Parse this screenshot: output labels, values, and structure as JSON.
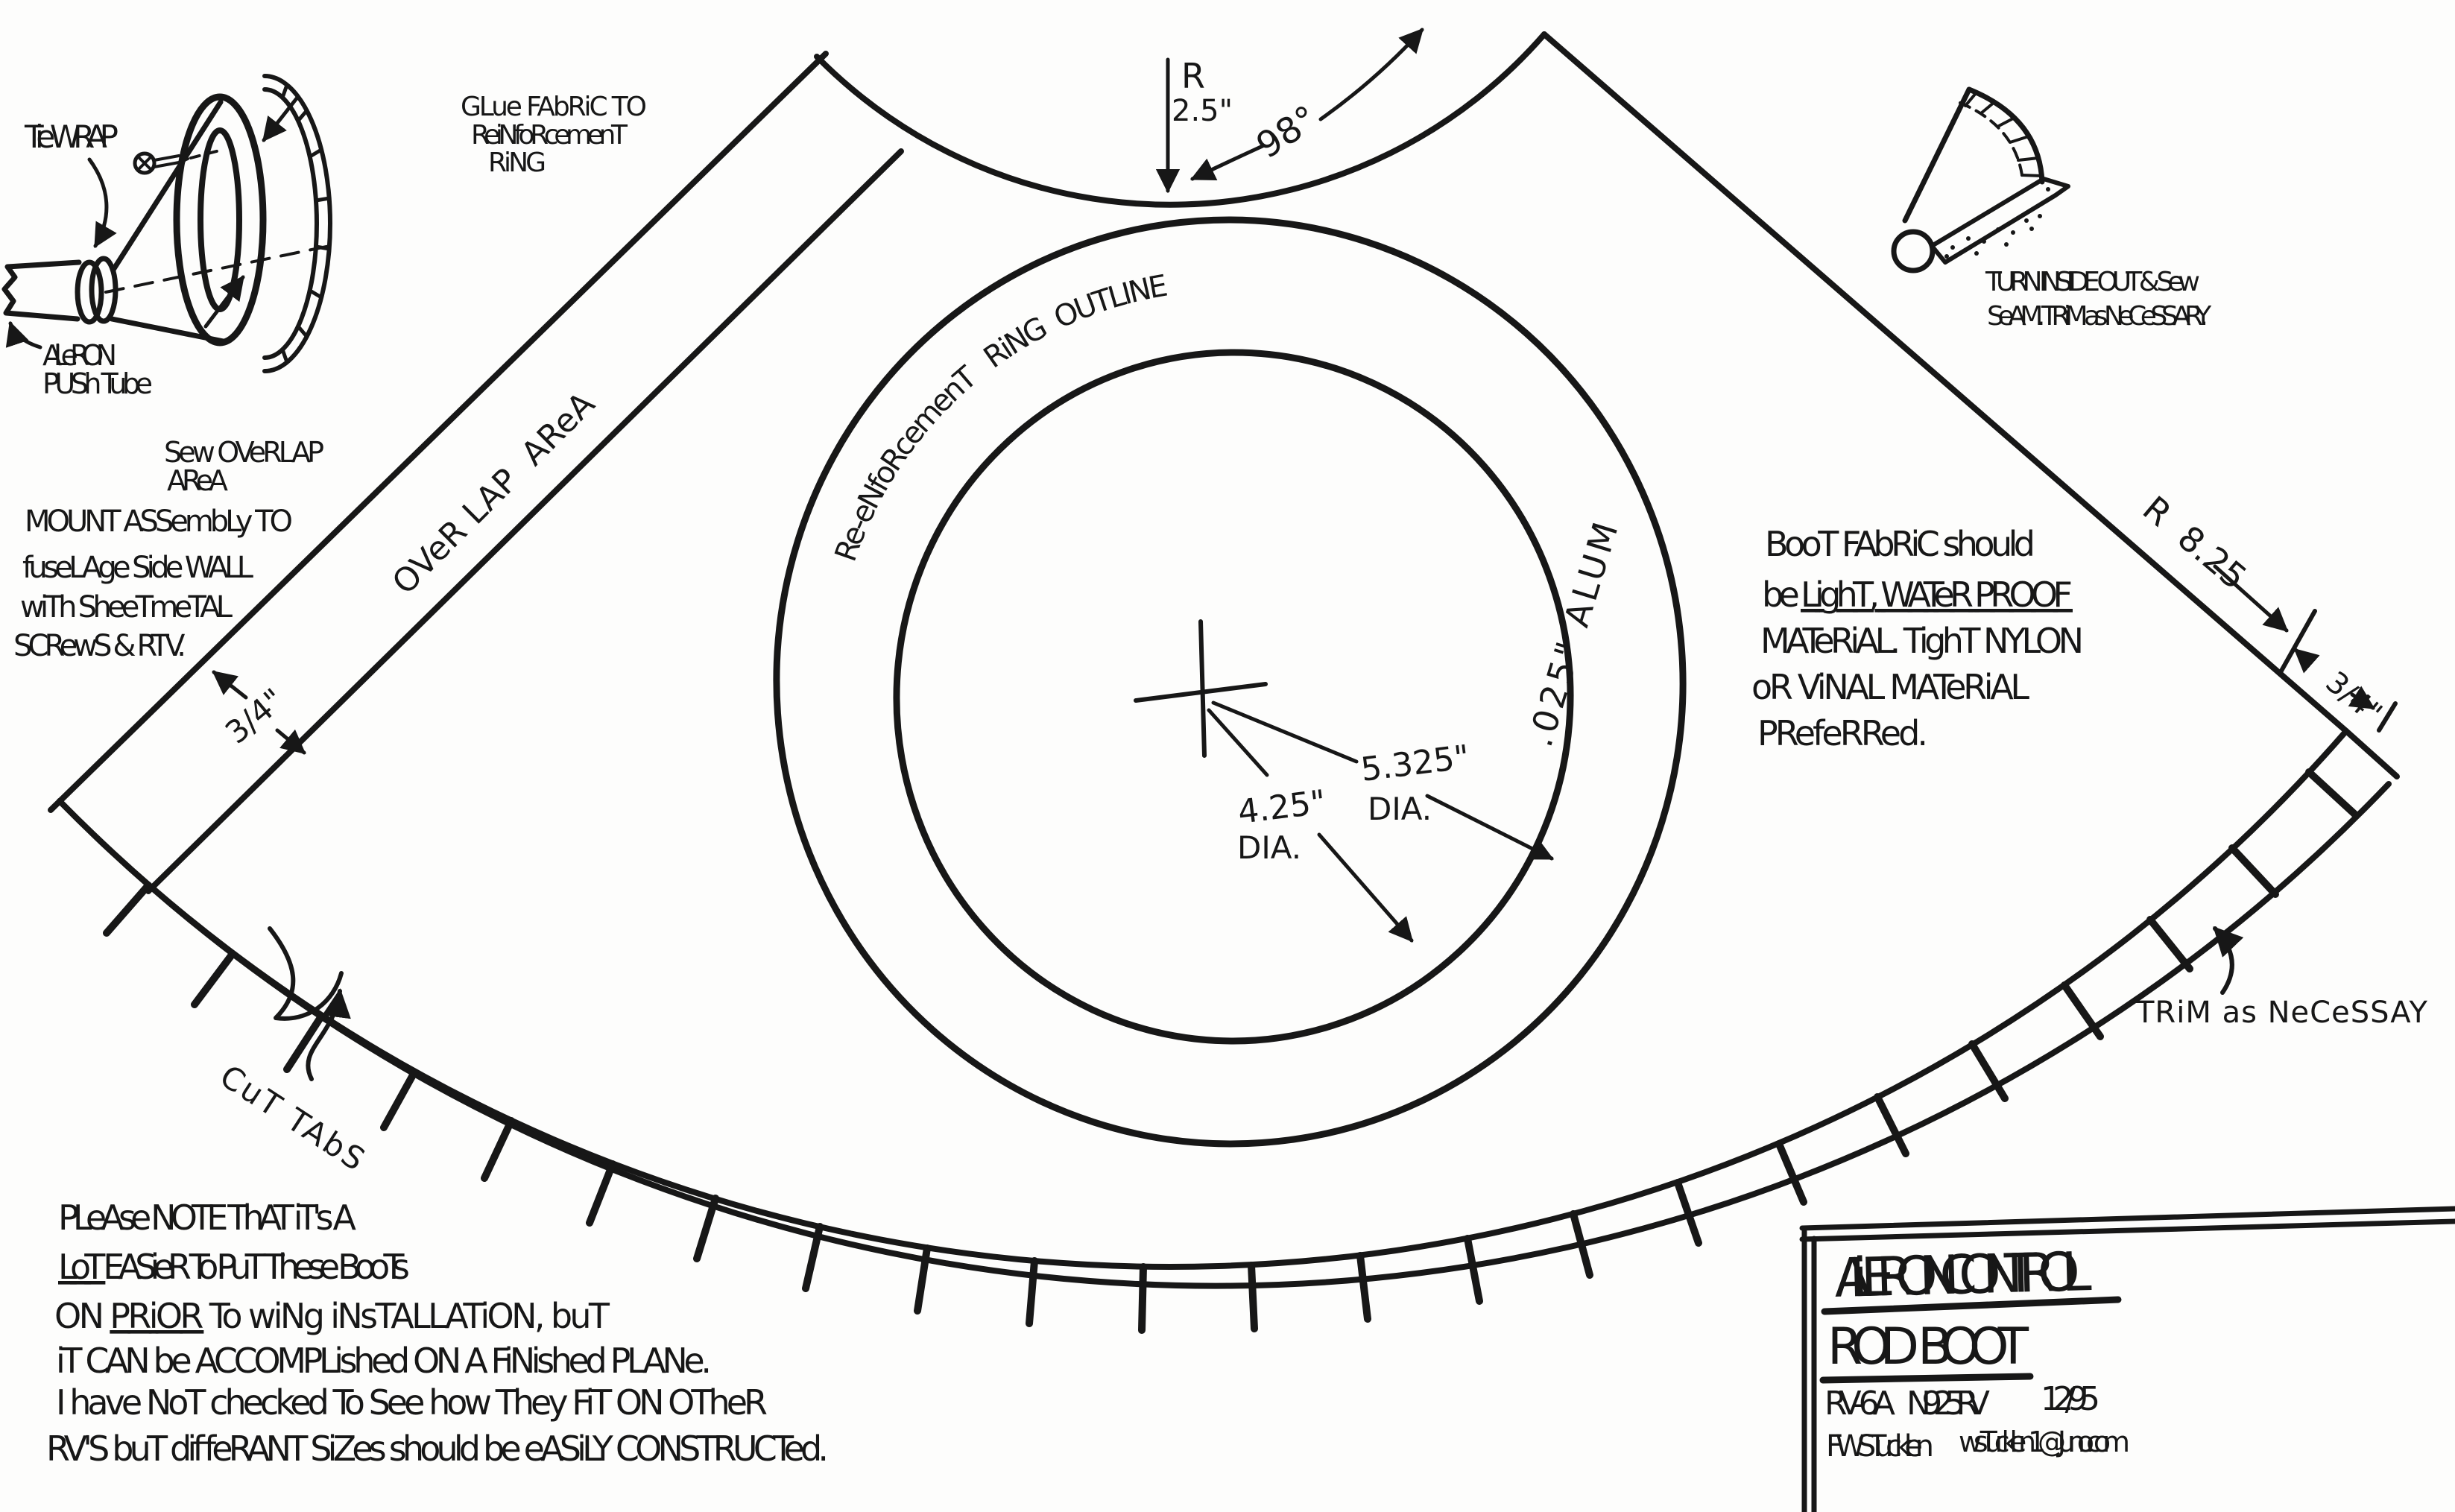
{
  "colors": {
    "ink": "#171717",
    "paper": "#fdfdfc"
  },
  "assembly_inset": {
    "tie_wrap": "Tie WRAP",
    "glue_note": {
      "l1": "GLue FAbRiC TO",
      "l2": "ReiNfoRcemenT",
      "l3": "RiNG"
    },
    "push_tube": {
      "l1": "AiLeRON",
      "l2": "PUSh Tube"
    },
    "sew_note": {
      "l1": "Sew OVeRLAP",
      "l2": "AReA"
    },
    "mount_note": {
      "l1": "MOUNT ASSembLy TO",
      "l2": "fuseLAge Side WALL",
      "l3": "wiTh SheeTmeTAL",
      "l4": "SCRewS & RTV."
    }
  },
  "turn_inset": {
    "l1": "TURN INSIDE OUT & Sew",
    "l2": "SeAM. TRiM as NeCeSSARY."
  },
  "pattern": {
    "overlap_area": "OVeR LAP  AReA",
    "inner_radius": {
      "r": "R",
      "value": "2.5\""
    },
    "angle": "98°",
    "ring_outline": "Re-eNfoRcemenT   RiNG  OUTLINE",
    "alum": ".025\" ALUM",
    "outer_dia": {
      "value": "5.325\"",
      "label": "DIA."
    },
    "inner_dia": {
      "value": "4.25\"",
      "label": "DIA."
    },
    "outer_radius": "R  8.25",
    "tab_left": "3/4\"",
    "tab_right": "3/4\"",
    "trim": "TRiM as NeCeSSAY",
    "cut_tabs": "CuT TAbS"
  },
  "fabric_note": {
    "l1": "BooT FAbRiC should",
    "l2_prefix": "be ",
    "l2_underlined": "LighT, WATeR PROOF",
    "l3": "MATeRiAL. TighT NYLON",
    "l4": "oR ViNAL MATeRiAL",
    "l5": "PRefeRRed."
  },
  "construction_note": {
    "l1": "PLeAse NOTE ThAT iT's A",
    "l2_underlined": "LoT",
    "l2_rest": " EASieR To PuT These BooTs",
    "l3_prefix": "ON ",
    "l3_underlined": "PRiOR",
    "l3_rest": " To wiNg iNsTALLATiON, buT",
    "l4": "iT CAN be ACCOMPLished ON A FiNished PLANe.",
    "l5": "I have NoT checked To See how They FiT ON OTheR",
    "l6": "RV'S buT diffeRANT SiZes should be eASiLY CONSTRUCTed."
  },
  "title_block": {
    "line1": "AiLERON CONTROL",
    "line2": "ROD  BOOT",
    "model": "RV-6A",
    "registration": "N925RV",
    "date": "12/95",
    "author": "FWSTucklen",
    "email": "wsTucklen1@Juno.com"
  }
}
